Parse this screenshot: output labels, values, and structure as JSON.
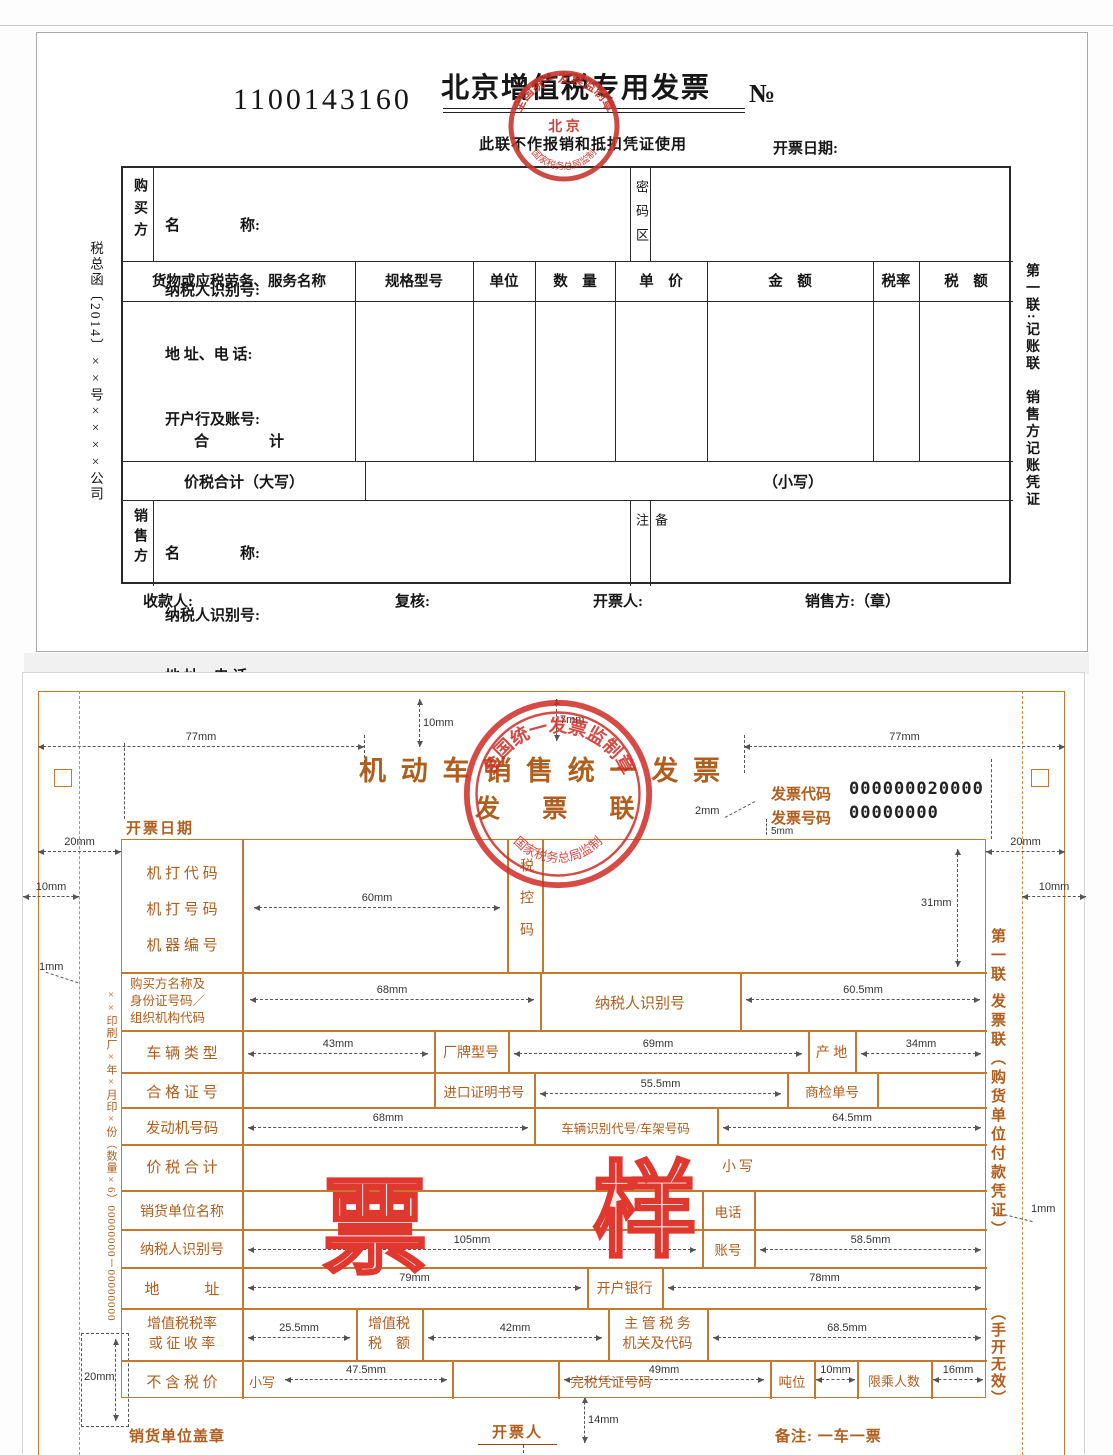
{
  "doc1": {
    "serial": "1100143160",
    "title": "北京增值税专用发票",
    "no_symbol": "№",
    "subtitle": "此联不作报销和抵扣凭证使用",
    "issue_date_label": "开票日期:",
    "left_vertical_note": "税总函〔2014〕××号××××公司",
    "right_vertical_note": "第一联:记账联　销售方记账凭证",
    "buyer_label": "购买方",
    "seller_label": "销售方",
    "party_fields": [
      "名　　　　称:",
      "纳税人识别号:",
      "地 址、电 话:",
      "开户行及账号:"
    ],
    "password_area_label": "密码区",
    "remark_label": "备注",
    "items_headers": [
      "货物或应税劳务、服务名称",
      "规格型号",
      "单位",
      "数　量",
      "单　价",
      "金　额",
      "税率",
      "税　额"
    ],
    "total_label": "合　　　　计",
    "tax_total_label": "价税合计（大写）",
    "small_caps_label": "（小写）",
    "footer": {
      "payee": "收款人:",
      "checker": "复核:",
      "drawer": "开票人:",
      "seller_seal": "销售方:（章）"
    },
    "stamp": {
      "arc_top": "全国统一发票监制章",
      "center": "北 京",
      "arc_bottom": "国家税务总局监制"
    }
  },
  "doc2": {
    "title": "机 动 车 销 售 统 一 发 票",
    "copy_name": "发 票 联",
    "invoice_code_label": "发票代码",
    "invoice_code_value": "000000020000",
    "invoice_number_label": "发票号码",
    "invoice_number_value": "00000000",
    "issue_date_label": "开票日期",
    "right_vertical_note": "第一联 发票联（购货单位付款凭证）",
    "right_vertical_note2": "（手开无效）",
    "left_vertical_note": "××印刷厂×年×月印×份（数量×6）00000000－00000000",
    "watermark_char1": "票",
    "watermark_char2": "样",
    "labels": {
      "machine_code": "机 打 代 码",
      "machine_number": "机 打 号 码",
      "machine_id": "机 器 编 号",
      "tax_control_code": "税控码",
      "buyer_info": "购买方名称及身份证号码／组织机构代码",
      "taxpayer_id": "纳税人识别号",
      "vehicle_type": "车 辆 类 型",
      "brand_model": "厂牌型号",
      "origin": "产 地",
      "certificate_no": "合 格 证 号",
      "import_certificate_no": "进口证明书号",
      "inspection_no": "商检单号",
      "engine_no": "发动机号码",
      "vin": "车辆识别代号/车架号码",
      "total_with_tax": "价 税 合 计",
      "small_caps": "小写",
      "seller_name": "销货单位名称",
      "phone": "电话",
      "seller_taxpayer_id": "纳税人识别号",
      "account_no": "账号",
      "address": "地　　　址",
      "bank": "开户银行",
      "vat_rate_line1": "增值税税率",
      "vat_rate_line2": "或 征 收 率",
      "vat_amount_line1": "增值税",
      "vat_amount_line2": "税　额",
      "tax_authority_line1": "主 管 税 务",
      "tax_authority_line2": "机关及代码",
      "price_without_tax": "不 含 税 价",
      "small_caps2": "小写",
      "tax_payment_cert_no": "完税凭证号码",
      "tonnage": "吨位",
      "passenger_limit": "限乘人数"
    },
    "footer": {
      "seller_seal": "销货单位盖章",
      "drawer": "开票人",
      "note": "备注: 一车一票"
    },
    "stamp": {
      "arc_top": "全国统一发票监制章",
      "arc_bottom": "国家税务总局监制"
    },
    "dims": {
      "w77": "77mm",
      "h10": "10mm",
      "h7": "7mm",
      "w2": "2mm",
      "h5": "5mm",
      "w20": "20mm",
      "w10": "10mm",
      "w1": "1mm",
      "h31": "31mm",
      "w60": "60mm",
      "w68": "68mm",
      "w60_5": "60.5mm",
      "w43": "43mm",
      "w69": "69mm",
      "w34": "34mm",
      "w55_5": "55.5mm",
      "w64_5": "64.5mm",
      "w105": "105mm",
      "w58_5": "58.5mm",
      "w79": "79mm",
      "w78": "78mm",
      "w25_5": "25.5mm",
      "w42": "42mm",
      "w68_5": "68.5mm",
      "w47_5": "47.5mm",
      "w49": "49mm",
      "w16": "16mm",
      "h14": "14mm"
    }
  },
  "colors": {
    "doc2_accent": "#b05e1d",
    "doc2_border": "#c4792f",
    "stamp_red": "#c5332b",
    "watermark_red": "#e0372e"
  }
}
